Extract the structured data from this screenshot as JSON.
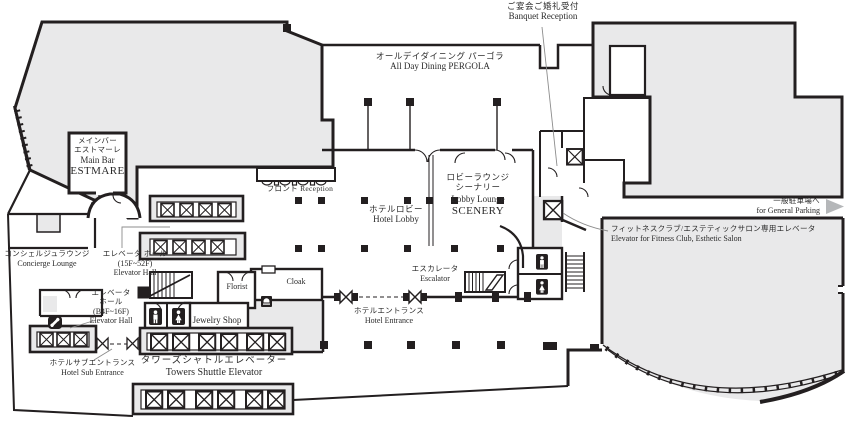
{
  "colors": {
    "wall": "#231f20",
    "area_fill": "#e9e9ea",
    "label_text": "#2a2a2a",
    "leader_line": "#8c8c8c",
    "parking_arrow": "#b5b7b9"
  },
  "labels": {
    "banquet_reception": {
      "lines": [
        "ご宴会ご婚礼受付",
        "Banquet Reception"
      ]
    },
    "all_day_dining": {
      "lines": [
        "オールデイダイニング パーゴラ",
        "All Day Dining PERGOLA"
      ]
    },
    "main_bar": {
      "lines": [
        "メインバー",
        "エストマーレ",
        "Main Bar",
        "ESTMARE"
      ]
    },
    "front_desk": {
      "lines": [
        "フロント Reception"
      ]
    },
    "hotel_lobby": {
      "lines": [
        "ホテルロビー",
        "Hotel Lobby"
      ]
    },
    "lobby_lounge": {
      "lines": [
        "ロビーラウンジ",
        "シーナリー",
        "Lobby Lounge",
        "SCENERY"
      ]
    },
    "concierge_lounge": {
      "lines": [
        "コンシェルジュラウンジ",
        "Concierge Lounge"
      ]
    },
    "elevator_hall_high": {
      "lines": [
        "エレベータ ホール",
        "(15F~52F)",
        "Elevator Hall"
      ]
    },
    "elevator_hall_low": {
      "lines": [
        "エレベータ",
        "ホール",
        "(B4F~16F)",
        "Elevator Hall"
      ]
    },
    "hotel_sub_entrance": {
      "lines": [
        "ホテルサブエントランス",
        "Hotel Sub Entrance"
      ]
    },
    "towers_shuttle_elevator": {
      "lines": [
        "タワーズシャトルエレベーター",
        "Towers Shuttle Elevator"
      ]
    },
    "florist": {
      "lines": [
        "Florist"
      ]
    },
    "jewelry_shop": {
      "lines": [
        "Jewelry Shop"
      ]
    },
    "cloak": {
      "lines": [
        "Cloak"
      ]
    },
    "hotel_entrance": {
      "lines": [
        "ホテルエントランス",
        "Hotel Entrance"
      ]
    },
    "escalator": {
      "lines": [
        "エスカレータ",
        "Escalator"
      ]
    },
    "fitness_elevator": {
      "lines": [
        "フィットネスクラブ/エステティックサロン専用エレベータ",
        "Elevator for Fitness Club, Esthetic Salon"
      ]
    },
    "general_parking": {
      "lines": [
        "一般駐車場へ",
        "for General Parking"
      ]
    }
  },
  "icons": {
    "elevator_icon": "crossed square ⊠",
    "mens_restroom_icon": "white standing figure on black plate",
    "womens_restroom_icon": "white figure in dress on black plate",
    "telephone_icon": "white handset on black plate",
    "service_bell_icon": "white bell on black plate",
    "parking_arrow_icon": "►",
    "revolving_door_icon": "bowtie / hourglass door symbol",
    "door_swing_icon": "quarter-arc door swing",
    "stairs_icon": "hatched staircase",
    "escalator_icon": "hatched escalator"
  }
}
